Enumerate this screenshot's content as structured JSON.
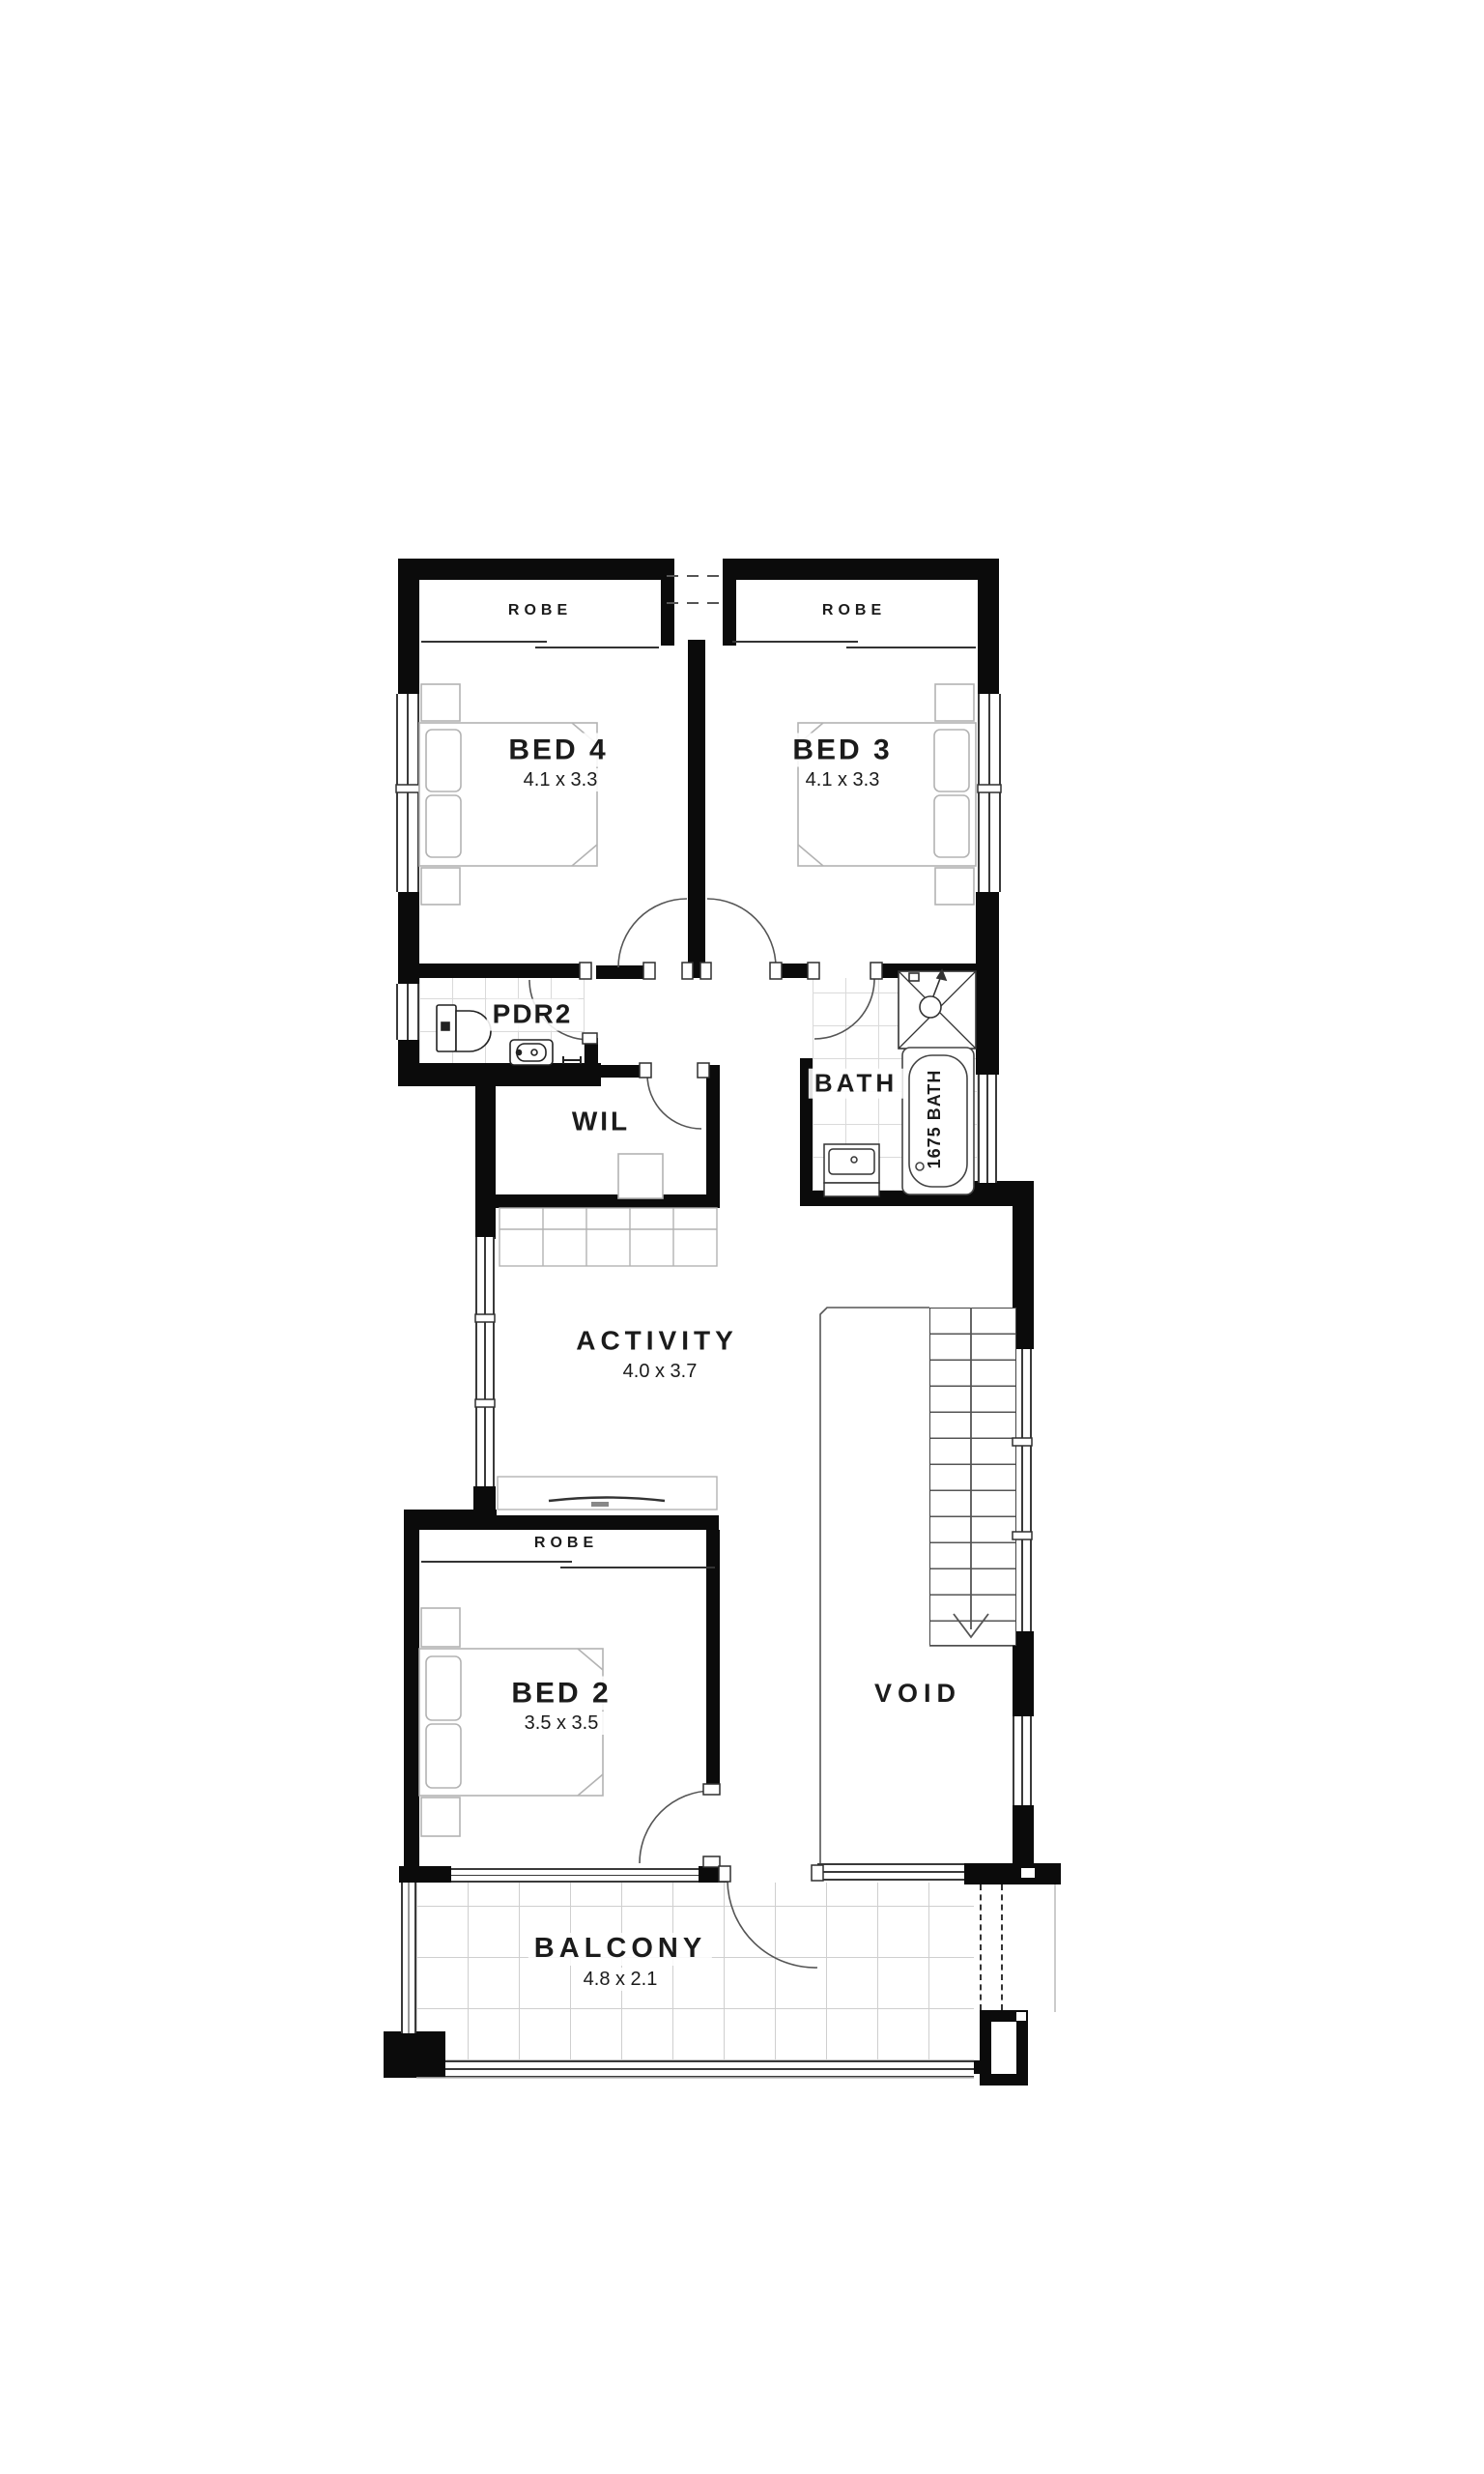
{
  "plan": {
    "title": "first-floor-plan",
    "rooms": {
      "bed4": {
        "label": "BED 4",
        "dims": "4.1 x 3.3"
      },
      "bed3": {
        "label": "BED 3",
        "dims": "4.1 x 3.3"
      },
      "bed2": {
        "label": "BED 2",
        "dims": "3.5 x 3.5"
      },
      "pdr2": {
        "label": "PDR2"
      },
      "wil": {
        "label": "WIL"
      },
      "bath": {
        "label": "BATH"
      },
      "activity": {
        "label": "ACTIVITY",
        "dims": "4.0 x 3.7"
      },
      "void": {
        "label": "VOID"
      },
      "balcony": {
        "label": "BALCONY",
        "dims": "4.8 x 2.1"
      }
    },
    "fixtures": {
      "robe_bed4": "ROBE",
      "robe_bed3": "ROBE",
      "robe_bed2": "ROBE",
      "bathtub_label": "1675 BATH"
    },
    "icons": {
      "stair_direction": "down-arrow",
      "shower": "shower-rose"
    },
    "colors": {
      "wall": "#0b0b0b",
      "tile_line": "#dadada",
      "furniture_line": "#b3b3b3",
      "door_arc": "#555555",
      "background": "#ffffff",
      "text": "#1b1b1b"
    }
  }
}
